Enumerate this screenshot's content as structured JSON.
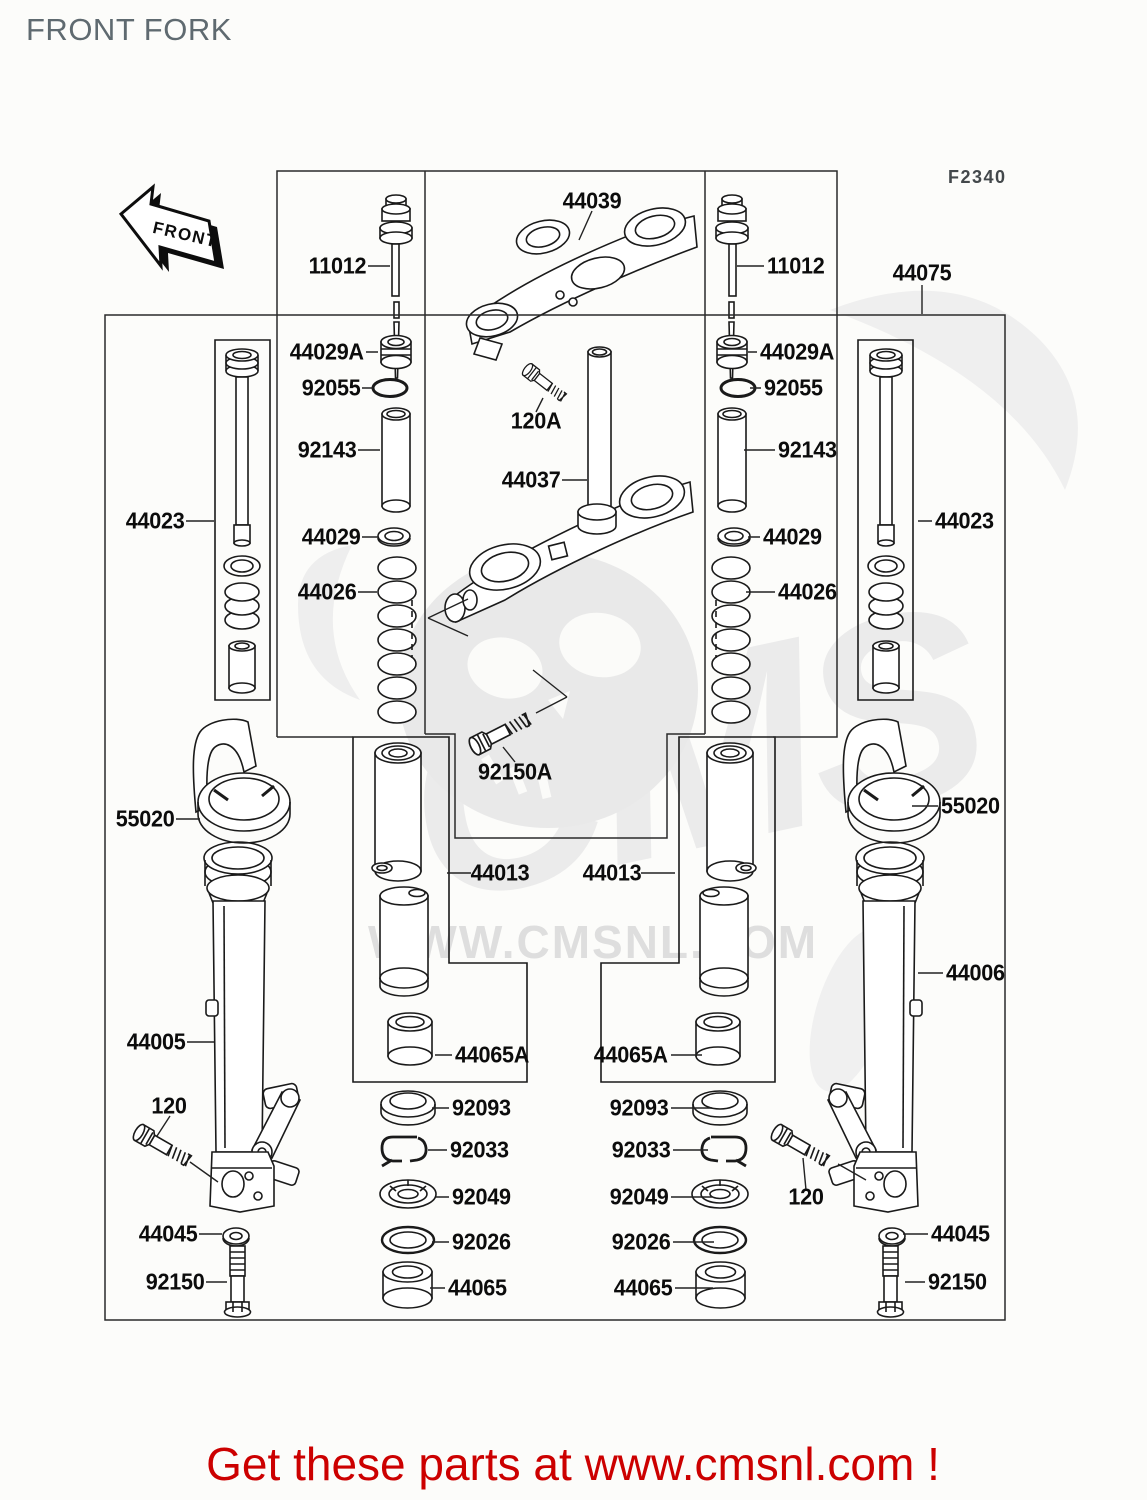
{
  "title": "FRONT FORK",
  "figure_code": "F2340",
  "front_arrow_label": "FRONT",
  "watermark": {
    "logo_text": "CMS",
    "site_text": "WWW.CMSNL.COM"
  },
  "footer": {
    "text": "Get these parts at www.cmsnl.com !"
  },
  "colors": {
    "footer_red": "#cc0000",
    "title_gray": "#5f6a70",
    "line_dark": "#1a1a1a",
    "watermark_gray": "#e9e9e9"
  },
  "part_labels": [
    {
      "t": "11012",
      "x": 366,
      "y": 266,
      "a": "end"
    },
    {
      "t": "44029A",
      "x": 364,
      "y": 352,
      "a": "end"
    },
    {
      "t": "92055",
      "x": 360,
      "y": 388,
      "a": "end"
    },
    {
      "t": "92143",
      "x": 356,
      "y": 450,
      "a": "end"
    },
    {
      "t": "44029",
      "x": 360,
      "y": 537,
      "a": "end"
    },
    {
      "t": "44026",
      "x": 356,
      "y": 592,
      "a": "end"
    },
    {
      "t": "44023",
      "x": 184,
      "y": 521,
      "a": "end"
    },
    {
      "t": "55020",
      "x": 174,
      "y": 819,
      "a": "end"
    },
    {
      "t": "44005",
      "x": 185,
      "y": 1042,
      "a": "end"
    },
    {
      "t": "120",
      "x": 169,
      "y": 1106,
      "a": "mid"
    },
    {
      "t": "44045",
      "x": 197,
      "y": 1234,
      "a": "end"
    },
    {
      "t": "92150",
      "x": 204,
      "y": 1282,
      "a": "end"
    },
    {
      "t": "44039",
      "x": 592,
      "y": 201,
      "a": "mid"
    },
    {
      "t": "120A",
      "x": 536,
      "y": 421,
      "a": "mid"
    },
    {
      "t": "44037",
      "x": 560,
      "y": 480,
      "a": "end"
    },
    {
      "t": "92150A",
      "x": 515,
      "y": 772,
      "a": "mid"
    },
    {
      "t": "44013",
      "x": 500,
      "y": 873,
      "a": "mid"
    },
    {
      "t": "44013",
      "x": 612,
      "y": 873,
      "a": "mid"
    },
    {
      "t": "44065A",
      "x": 455,
      "y": 1055,
      "a": "start"
    },
    {
      "t": "44065A",
      "x": 668,
      "y": 1055,
      "a": "end"
    },
    {
      "t": "92093",
      "x": 452,
      "y": 1108,
      "a": "start"
    },
    {
      "t": "92033",
      "x": 450,
      "y": 1150,
      "a": "start"
    },
    {
      "t": "92049",
      "x": 452,
      "y": 1197,
      "a": "start"
    },
    {
      "t": "92026",
      "x": 452,
      "y": 1242,
      "a": "start"
    },
    {
      "t": "44065",
      "x": 448,
      "y": 1288,
      "a": "start"
    },
    {
      "t": "92093",
      "x": 668,
      "y": 1108,
      "a": "end"
    },
    {
      "t": "92033",
      "x": 670,
      "y": 1150,
      "a": "end"
    },
    {
      "t": "92049",
      "x": 668,
      "y": 1197,
      "a": "end"
    },
    {
      "t": "92026",
      "x": 670,
      "y": 1242,
      "a": "end"
    },
    {
      "t": "44065",
      "x": 672,
      "y": 1288,
      "a": "end"
    },
    {
      "t": "11012",
      "x": 767,
      "y": 266,
      "a": "start"
    },
    {
      "t": "44029A",
      "x": 760,
      "y": 352,
      "a": "start"
    },
    {
      "t": "92055",
      "x": 764,
      "y": 388,
      "a": "start"
    },
    {
      "t": "92143",
      "x": 778,
      "y": 450,
      "a": "start"
    },
    {
      "t": "44029",
      "x": 763,
      "y": 537,
      "a": "start"
    },
    {
      "t": "44026",
      "x": 778,
      "y": 592,
      "a": "start"
    },
    {
      "t": "44075",
      "x": 922,
      "y": 273,
      "a": "mid"
    },
    {
      "t": "44023",
      "x": 935,
      "y": 521,
      "a": "start"
    },
    {
      "t": "55020",
      "x": 941,
      "y": 806,
      "a": "start"
    },
    {
      "t": "44006",
      "x": 946,
      "y": 973,
      "a": "start"
    },
    {
      "t": "120",
      "x": 806,
      "y": 1197,
      "a": "mid"
    },
    {
      "t": "44045",
      "x": 931,
      "y": 1234,
      "a": "start"
    },
    {
      "t": "92150",
      "x": 928,
      "y": 1282,
      "a": "start"
    }
  ]
}
